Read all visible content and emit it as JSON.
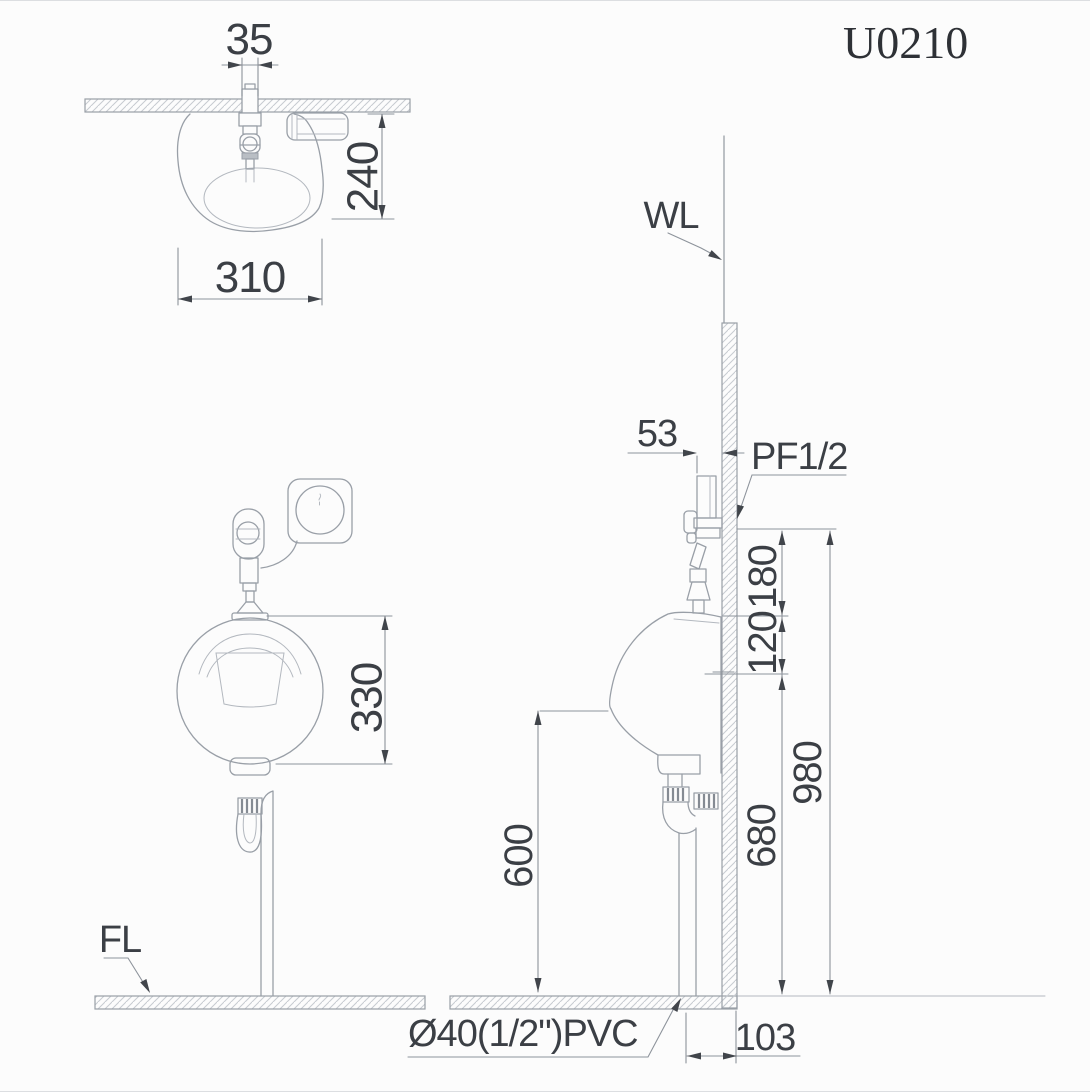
{
  "title": "U0210",
  "colors": {
    "background": "#fcfcfc",
    "line": "#999fa7",
    "line_light": "#b3b8bf",
    "hatch": "#c6cad0",
    "text": "#3b3f45",
    "arrow": "#41454b"
  },
  "plan_view": {
    "dim_spud_width": "35",
    "dim_depth": "240",
    "dim_width": "310"
  },
  "front_view": {
    "dim_bowl_height": "330",
    "floor_line_label": "FL"
  },
  "side_view": {
    "wall_line_label": "WL",
    "dim_valve_to_wall": "53",
    "water_inlet_label": "PF1/2",
    "dim_inlet_to_rim": "180",
    "dim_rim_to_drain": "120",
    "dim_inlet_height": "980",
    "dim_drain_height": "680",
    "dim_lip_height": "600",
    "dim_drain_to_wall": "103",
    "drain_pipe_label": "Ø40(1/2\")PVC"
  }
}
